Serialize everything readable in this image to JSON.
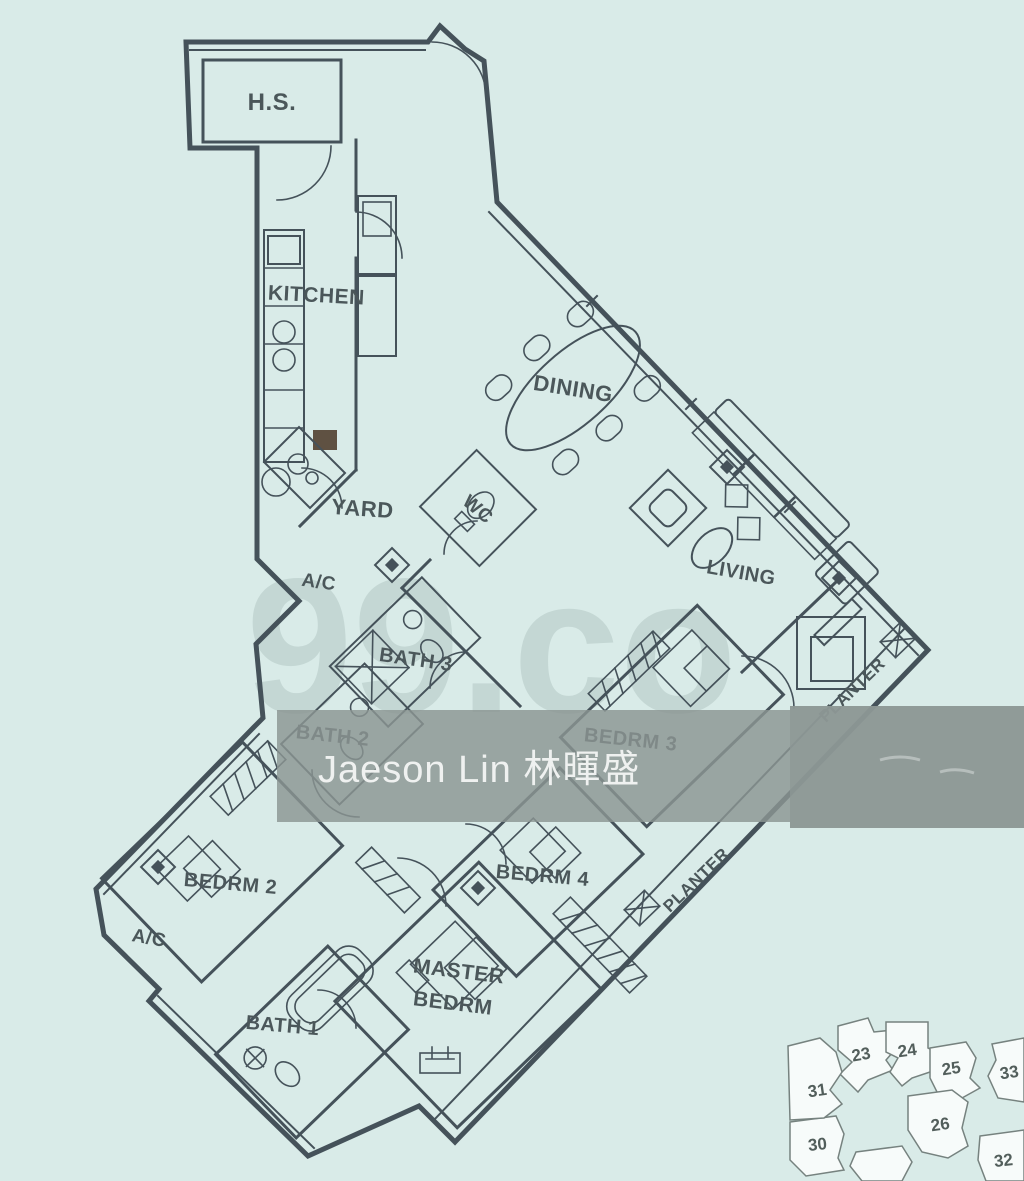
{
  "image": {
    "width": 1024,
    "height": 1181,
    "background": "#d9ebe8"
  },
  "floorplan": {
    "line_color": "#45525a",
    "label_color": "#4b575a",
    "rooms": {
      "hs": "H.S.",
      "kitchen": "KITCHEN",
      "dining": "DINING",
      "yard": "YARD",
      "wc": "WC",
      "ac_mid": "A/C",
      "living": "LIVING",
      "bath3": "BATH 3",
      "bath2": "BATH 2",
      "bedrm3": "BEDRM 3",
      "bedrm2": "BEDRM 2",
      "ac_left": "A/C",
      "bedrm4": "BEDRM 4",
      "master_line1": "MASTER",
      "master_line2": "BEDRM",
      "bath1": "BATH 1",
      "planter_upper": "PLANTER",
      "planter_lower": "PLANTER"
    }
  },
  "watermarks": {
    "brand": "99.co",
    "agent": "Jaeson Lin 林暉盛",
    "band_color": "#8b9593",
    "text_color": "#f4f6f5"
  },
  "keyplan": {
    "units": [
      {
        "label": "23"
      },
      {
        "label": "24"
      },
      {
        "label": "25"
      },
      {
        "label": "26"
      },
      {
        "label": "30"
      },
      {
        "label": "31"
      },
      {
        "label": "32"
      },
      {
        "label": "33"
      }
    ]
  }
}
